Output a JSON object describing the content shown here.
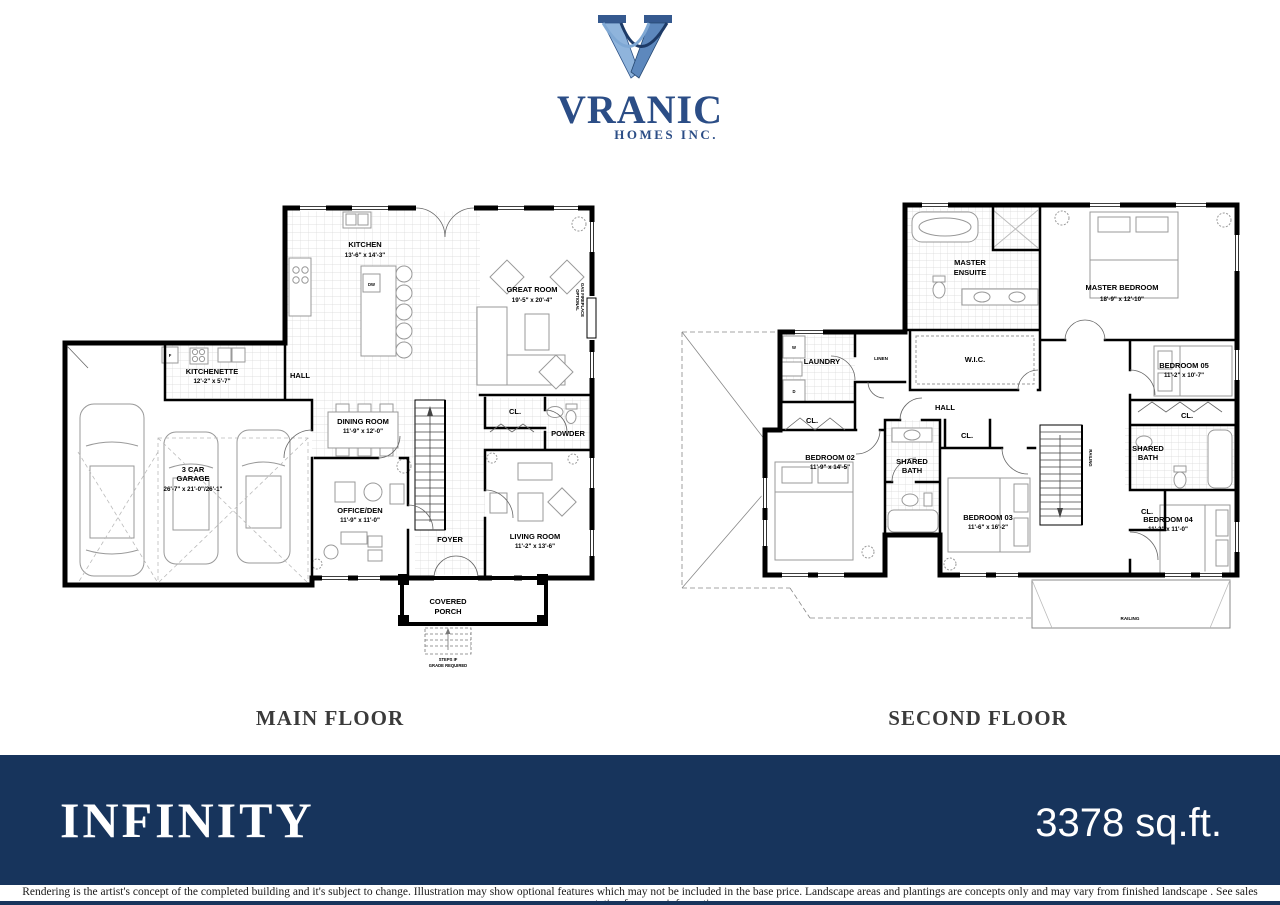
{
  "brand": {
    "name": "VRANIC",
    "tagline": "HOMES INC."
  },
  "floors": {
    "main": {
      "title": "MAIN FLOOR",
      "rooms": {
        "kitchen": {
          "name": "KITCHEN",
          "dims": "13'-6\" x 14'-3\""
        },
        "great_room": {
          "name": "GREAT ROOM",
          "dims": "19'-5\" x 20'-4\""
        },
        "fireplace": {
          "line1": "OPTIONAL",
          "line2": "GAS FIREPLACE"
        },
        "dw": {
          "name": "DW"
        },
        "fridge": {
          "name": "F"
        },
        "kitchenette": {
          "name": "KITCHENETTE",
          "dims": "12'-2\" x 5'-7\""
        },
        "hall": {
          "name": "HALL"
        },
        "dining": {
          "name": "DINING ROOM",
          "dims": "11'-9\" x 12'-0\""
        },
        "garage": {
          "line1": "3 CAR",
          "line2": "GARAGE",
          "dims": "26'-7\" x 21'-0\"/26'-1\""
        },
        "office": {
          "name": "OFFICE/DEN",
          "dims": "11'-9\" x 11'-0\""
        },
        "foyer": {
          "name": "FOYER"
        },
        "living": {
          "name": "LIVING ROOM",
          "dims": "11'-2\" x 13'-6\""
        },
        "powder": {
          "name": "POWDER"
        },
        "closet": {
          "name": "CL."
        },
        "porch": {
          "line1": "COVERED",
          "line2": "PORCH"
        },
        "steps": {
          "line1": "STEPS IF",
          "line2": "GRADE REQUIRED"
        }
      }
    },
    "second": {
      "title": "SECOND FLOOR",
      "rooms": {
        "master_ensuite": {
          "line1": "MASTER",
          "line2": "ENSUITE"
        },
        "master_bedroom": {
          "name": "MASTER BEDROOM",
          "dims": "18'-9\" x 12'-10\""
        },
        "wic": {
          "name": "W.I.C."
        },
        "laundry": {
          "name": "LAUNDRY"
        },
        "linen": {
          "name": "LINEN"
        },
        "hall": {
          "name": "HALL"
        },
        "bedroom02": {
          "name": "BEDROOM 02",
          "dims": "11'-9\" x 14'-5\""
        },
        "bedroom03": {
          "name": "BEDROOM 03",
          "dims": "11'-6\" x 16'-2\""
        },
        "bedroom04": {
          "name": "BEDROOM 04",
          "dims": "11'-2\" x 11'-0\""
        },
        "bedroom05": {
          "name": "BEDROOM 05",
          "dims": "11'-2\" x 10'-7\""
        },
        "shared_bath": {
          "line1": "SHARED",
          "line2": "BATH"
        },
        "closet": {
          "name": "CL."
        },
        "railing": {
          "name": "RAILING"
        },
        "washer": {
          "name": "W"
        },
        "dryer": {
          "name": "D"
        }
      }
    }
  },
  "footer": {
    "model_name": "INFINITY",
    "area": "3378 sq.ft.",
    "disclaimer": "Rendering is the artist's concept of the completed building  and it's subject to change. Illustration may show optional features which may not be included in the base price. Landscape areas and plantings are concepts only and may vary from  finished landscape .  See sales representative for more information."
  },
  "colors": {
    "banner": "#17345C",
    "logo_navy": "#2b4d86"
  }
}
